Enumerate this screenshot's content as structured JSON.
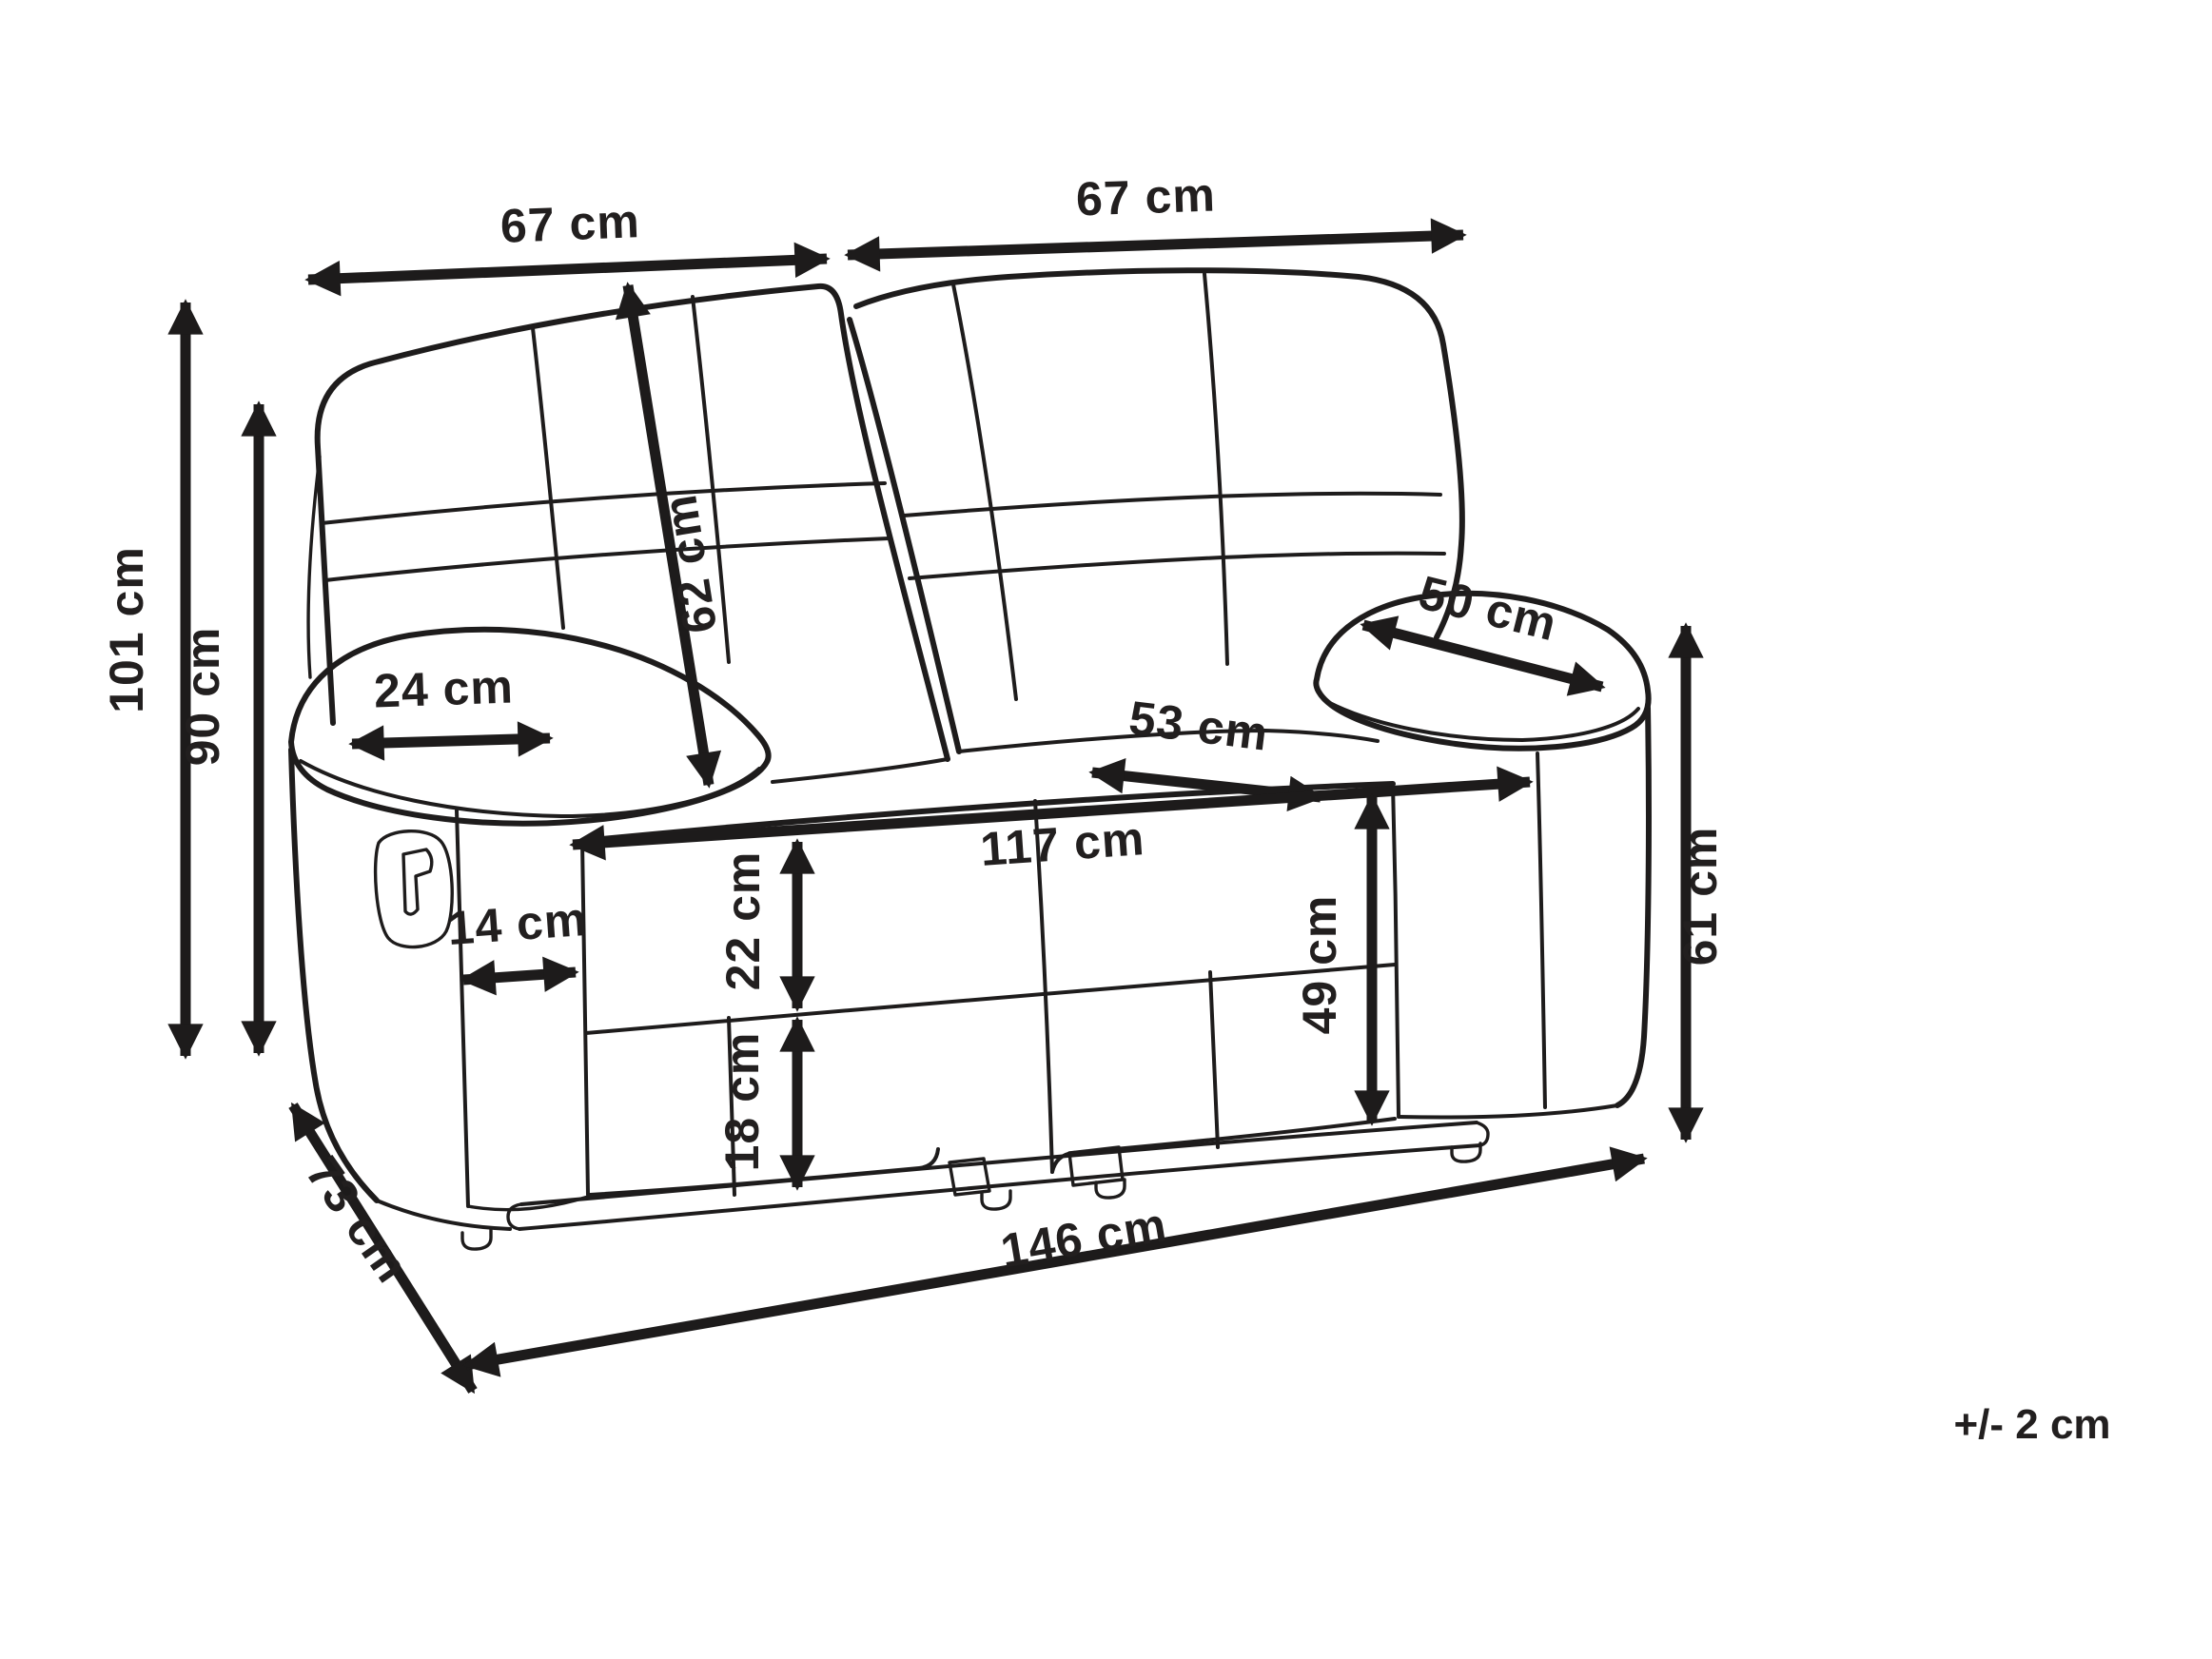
{
  "diagram": {
    "type": "furniture-dimension-drawing",
    "subject": "two-seat recliner sofa line drawing with measurements",
    "unit": "cm",
    "tolerance_note": "+/- 2 cm",
    "labels": {
      "seat_width_left": "67 cm",
      "seat_width_right": "67 cm",
      "overall_height": "101 cm",
      "backrest_height": "90 cm",
      "backrest_diagonal": "62 cm",
      "armrest_top_width": "24 cm",
      "armrest_pad_length": "50 cm",
      "seat_depth": "53 cm",
      "inner_seat_width": "117 cm",
      "seat_height": "49 cm",
      "seat_front_height": "22 cm",
      "base_height": "18 cm",
      "armrest_front_width": "14 cm",
      "overall_depth": "73 cm",
      "overall_width": "146 cm",
      "armrest_side_height": "61 cm"
    }
  }
}
